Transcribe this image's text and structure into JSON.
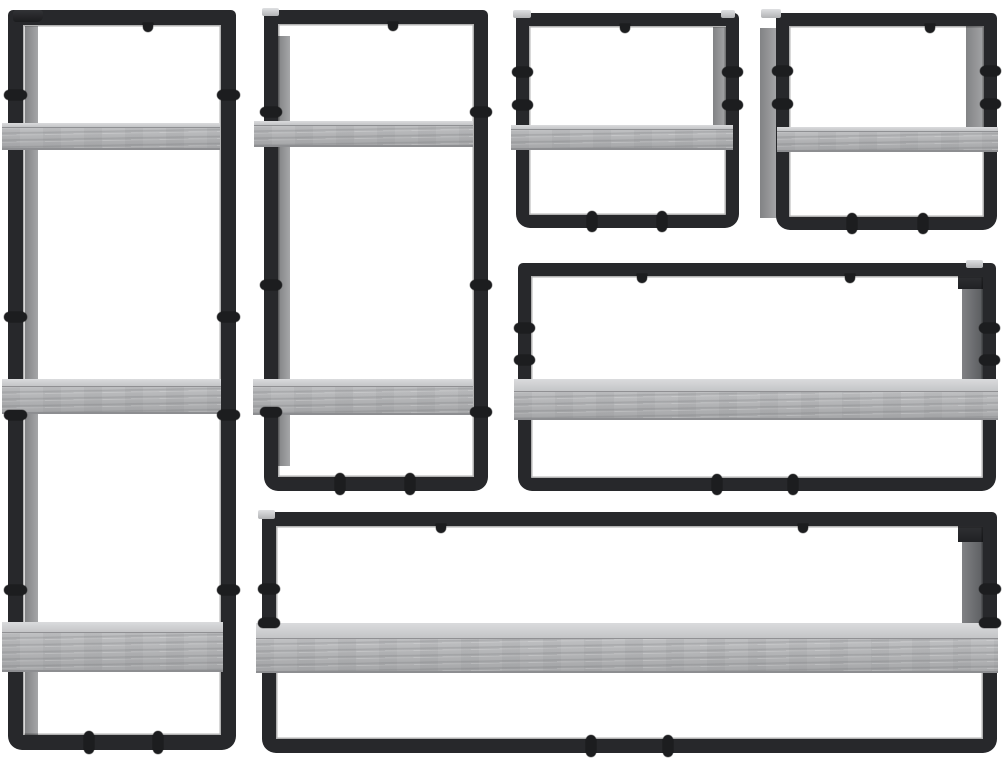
{
  "image": {
    "alt": "Product photo of a 6-piece industrial wall shelf set: grey sonoma engineered-wood boards held by black powder-coated metal frames, arranged on a plain white background",
    "width": 1007,
    "height": 763
  },
  "palette": {
    "background": "#ffffff",
    "frame_color": "#27282b",
    "frame_dark": "#1a1b1d",
    "bolt_color": "#1c1d1f",
    "wood_top": "#cdced0",
    "wood_front": "#b2b3b5",
    "wood_grain": "#9a9b9e",
    "wood_edge": "#8d8e91",
    "wood_side": "#959698",
    "dark_side": "#58595c",
    "tab_silver": "#cfd0d2"
  },
  "scene": {
    "background": "#ffffff",
    "units": [
      {
        "id": "tall-shelf-unit",
        "label": "3-tier vertical wall shelf",
        "frame": {
          "x": 8,
          "y": 10,
          "w": 228,
          "h": 740,
          "t": 15
        },
        "panels": [
          {
            "x": 25,
            "y": 26,
            "w": 13,
            "h": 716,
            "tone": "wood"
          }
        ],
        "boards": [
          {
            "x": 2,
            "y": 123,
            "w": 218,
            "top": 5,
            "front": 22
          },
          {
            "x": 2,
            "y": 379,
            "w": 219,
            "top": 8,
            "front": 27
          },
          {
            "x": 2,
            "y": 622,
            "w": 221,
            "top": 11,
            "front": 39
          }
        ],
        "post_bolts": [
          95,
          317,
          415,
          590
        ],
        "bottom_bolts": [
          89,
          158
        ],
        "top_hooks": [
          148
        ],
        "tabs": [
          {
            "x": 13,
            "y": 10,
            "w": 30,
            "h": 12,
            "tone": "dark"
          }
        ]
      },
      {
        "id": "two-tier-shelf-unit",
        "label": "2-tier vertical wall shelf",
        "frame": {
          "x": 264,
          "y": 10,
          "w": 224,
          "h": 481,
          "t": 14
        },
        "panels": [
          {
            "x": 278,
            "y": 36,
            "w": 12,
            "h": 430,
            "tone": "wood"
          }
        ],
        "boards": [
          {
            "x": 254,
            "y": 121,
            "w": 219,
            "top": 5,
            "front": 21
          },
          {
            "x": 253,
            "y": 379,
            "w": 220,
            "top": 8,
            "front": 28
          }
        ],
        "post_bolts": [
          112,
          285,
          412
        ],
        "bottom_bolts": [
          340,
          410
        ],
        "top_hooks": [
          393
        ],
        "tabs": [
          {
            "x": 262,
            "y": 8,
            "w": 17,
            "h": 8,
            "tone": "silver"
          }
        ]
      },
      {
        "id": "small-shelf-unit-left",
        "label": "single-board wall shelf, small (top middle)",
        "frame": {
          "x": 516,
          "y": 13,
          "w": 223,
          "h": 215,
          "t": 13
        },
        "panels": [
          {
            "x": 713,
            "y": 27,
            "w": 13,
            "h": 112,
            "tone": "wood"
          }
        ],
        "boards": [
          {
            "x": 511,
            "y": 125,
            "w": 222,
            "top": 5,
            "front": 20
          }
        ],
        "post_bolts": [
          72,
          105
        ],
        "bottom_bolts": [
          592,
          662
        ],
        "top_hooks": [
          625
        ],
        "tabs": [
          {
            "x": 513,
            "y": 10,
            "w": 18,
            "h": 8,
            "tone": "silver"
          },
          {
            "x": 721,
            "y": 10,
            "w": 14,
            "h": 8,
            "tone": "silver"
          }
        ]
      },
      {
        "id": "small-shelf-unit-right",
        "label": "single-board wall shelf, small (top right)",
        "frame": {
          "x": 776,
          "y": 13,
          "w": 221,
          "h": 217,
          "t": 13
        },
        "panels": [
          {
            "x": 760,
            "y": 28,
            "w": 17,
            "h": 190,
            "tone": "wood"
          },
          {
            "x": 966,
            "y": 26,
            "w": 19,
            "h": 118,
            "tone": "wood"
          }
        ],
        "boards": [
          {
            "x": 777,
            "y": 127,
            "w": 221,
            "top": 5,
            "front": 20
          }
        ],
        "post_bolts": [
          71,
          104
        ],
        "bottom_bolts": [
          852,
          923
        ],
        "top_hooks": [
          930
        ],
        "tabs": [
          {
            "x": 761,
            "y": 9,
            "w": 20,
            "h": 9,
            "tone": "silver"
          }
        ]
      },
      {
        "id": "wide-shelf-unit",
        "label": "single-board wall shelf, wide (middle right)",
        "frame": {
          "x": 518,
          "y": 263,
          "w": 478,
          "h": 228,
          "t": 13
        },
        "panels": [
          {
            "x": 962,
            "y": 277,
            "w": 22,
            "h": 103,
            "tone": "darkwood"
          },
          {
            "x": 958,
            "y": 265,
            "w": 26,
            "h": 24,
            "tone": "dark"
          }
        ],
        "boards": [
          {
            "x": 514,
            "y": 379,
            "w": 484,
            "top": 13,
            "front": 28
          }
        ],
        "post_bolts": [
          328,
          360
        ],
        "bottom_bolts": [
          717,
          793
        ],
        "top_hooks": [
          642,
          850
        ],
        "tabs": [
          {
            "x": 966,
            "y": 260,
            "w": 17,
            "h": 8,
            "tone": "silver"
          }
        ]
      },
      {
        "id": "long-shelf-unit",
        "label": "single-board wall shelf, long (bottom)",
        "frame": {
          "x": 262,
          "y": 512,
          "w": 735,
          "h": 241,
          "t": 14
        },
        "panels": [
          {
            "x": 962,
            "y": 528,
            "w": 24,
            "h": 114,
            "tone": "darkwood"
          },
          {
            "x": 958,
            "y": 514,
            "w": 28,
            "h": 28,
            "tone": "dark"
          }
        ],
        "boards": [
          {
            "x": 256,
            "y": 623,
            "w": 742,
            "top": 16,
            "front": 34
          }
        ],
        "post_bolts": [
          589,
          623
        ],
        "bottom_bolts": [
          591,
          668
        ],
        "top_hooks": [
          441,
          803
        ],
        "tabs": [
          {
            "x": 258,
            "y": 510,
            "w": 17,
            "h": 9,
            "tone": "silver"
          }
        ]
      }
    ]
  }
}
